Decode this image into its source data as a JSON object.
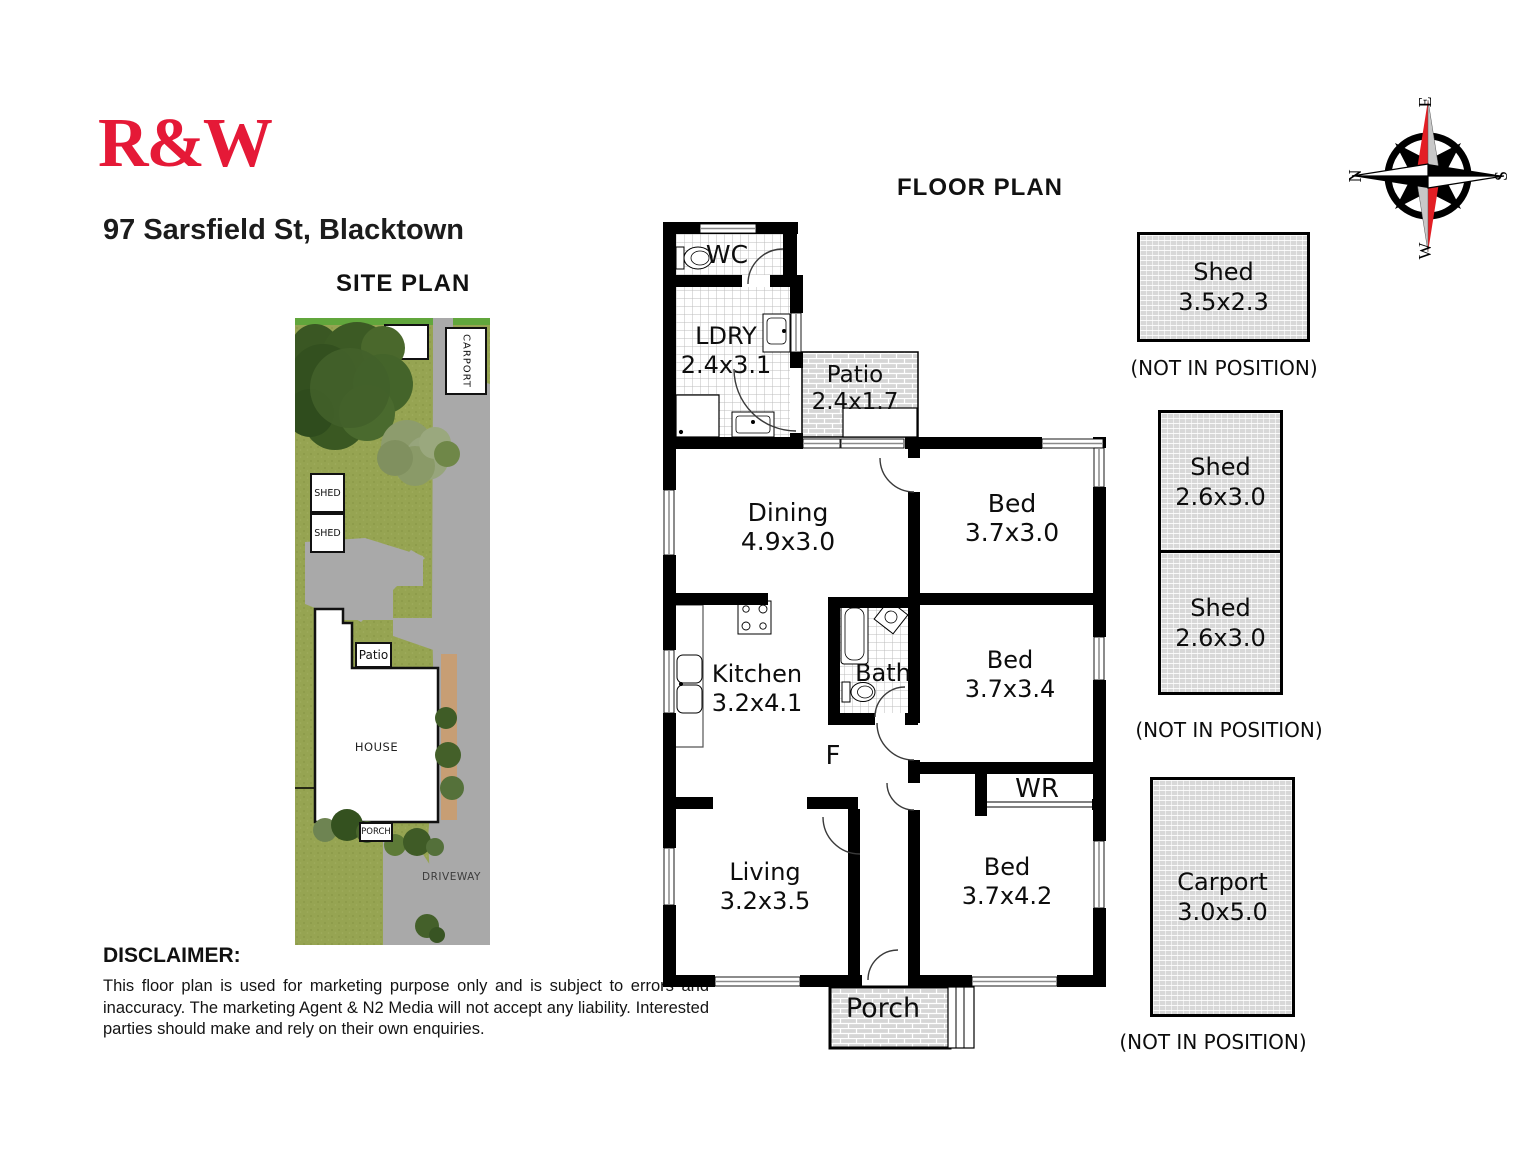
{
  "brand": {
    "logo_text": "R&W",
    "logo_color": "#e51937"
  },
  "header": {
    "address": "97 Sarsfield St, Blacktown",
    "site_plan_title": "SITE PLAN",
    "floor_plan_title": "FLOOR PLAN"
  },
  "compass": {
    "north": "N",
    "east": "E",
    "south": "S",
    "west": "W"
  },
  "floor_plan": {
    "rooms": {
      "wc": {
        "name": "WC",
        "dims": ""
      },
      "ldry": {
        "name": "LDRY",
        "dims": "2.4x3.1"
      },
      "patio": {
        "name": "Patio",
        "dims": "2.4x1.7"
      },
      "dining": {
        "name": "Dining",
        "dims": "4.9x3.0"
      },
      "bed1": {
        "name": "Bed",
        "dims": "3.7x3.0"
      },
      "kitchen": {
        "name": "Kitchen",
        "dims": "3.2x4.1"
      },
      "bath": {
        "name": "Bath",
        "dims": ""
      },
      "fridge": {
        "name": "F",
        "dims": ""
      },
      "bed2": {
        "name": "Bed",
        "dims": "3.7x3.4"
      },
      "wr": {
        "name": "WR",
        "dims": ""
      },
      "living": {
        "name": "Living",
        "dims": "3.2x3.5"
      },
      "bed3": {
        "name": "Bed",
        "dims": "3.7x4.2"
      },
      "porch": {
        "name": "Porch",
        "dims": ""
      }
    }
  },
  "outbuildings": {
    "shed1": {
      "name": "Shed",
      "dims": "3.5x2.3",
      "note": "(NOT IN POSITION)"
    },
    "shed2": {
      "name": "Shed",
      "dims": "2.6x3.0"
    },
    "shed3": {
      "name": "Shed",
      "dims": "2.6x3.0"
    },
    "sheds_note": "(NOT IN POSITION)",
    "carport": {
      "name": "Carport",
      "dims": "3.0x5.0",
      "note": "(NOT IN POSITION)"
    }
  },
  "site_plan": {
    "labels": {
      "carport": "CARPORT",
      "shed_upper": "SHED",
      "shed_lower": "SHED",
      "patio": "Patio",
      "house": "HOUSE",
      "porch": "PORCH",
      "driveway": "DRIVEWAY"
    }
  },
  "disclaimer": {
    "heading": "DISCLAIMER:",
    "body": "This floor plan is used for marketing purpose only and is subject to errors and inaccuracy. The marketing Agent & N2 Media will not accept any liability. Interested parties should make and rely on their own enquiries."
  }
}
